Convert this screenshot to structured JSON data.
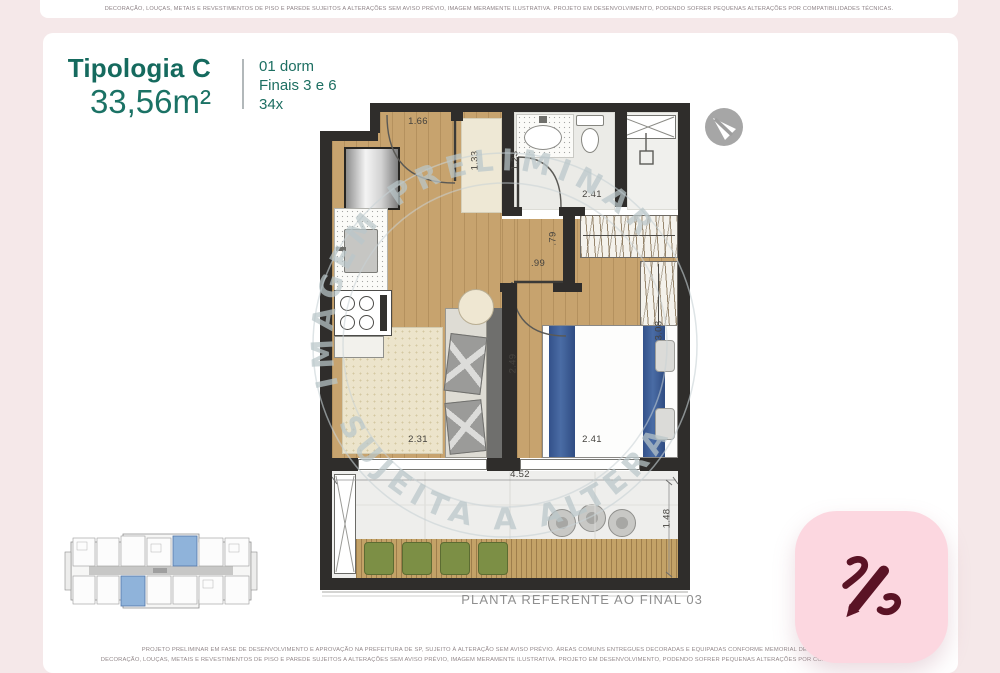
{
  "top_bar": {
    "disclaimer": "DECORAÇÃO, LOUÇAS, METAIS E REVESTIMENTOS DE PISO E PAREDE SUJEITOS A ALTERAÇÕES SEM AVISO PRÉVIO, IMAGEM MERAMENTE ILUSTRATIVA. PROJETO EM DESENVOLVIMENTO, PODENDO SOFRER PEQUENAS ALTERAÇÕES POR COMPATIBILIDADES TÉCNICAS."
  },
  "header": {
    "typology": "Tipologia C",
    "area": "33,56m²",
    "info_lines": [
      "01 dorm",
      "Finais 3 e 6",
      "34x"
    ],
    "accent_color": "#156a5e"
  },
  "plan": {
    "caption": "PLANTA REFERENTE AO FINAL 03",
    "watermark": {
      "upper": "IMAGEM PRELIMINAR",
      "lower": "SUJEITA A ALTERAÇÃO"
    },
    "dimensions": {
      "entry": "1.66",
      "closet": "1.33",
      "bath_width": "1.23",
      "bath_length": "2.41",
      "nook": ".79",
      "bedroom_door": ".99",
      "living_depth": "2.49",
      "living_width": "2.31",
      "bedroom_width": "2.41",
      "bedroom_depth": "3.08",
      "terrace_width": "4.52",
      "terrace_depth": "1.48"
    }
  },
  "footer": {
    "line1": "PROJETO PRELIMINAR EM FASE DE DESENVOLVIMENTO E APROVAÇÃO NA PREFEITURA DE SP, SUJEITO À ALTERAÇÃO SEM AVISO PRÉVIO. ÁREAS COMUNS ENTREGUES DECORADAS E EQUIPADAS CONFORME MEMORIAL DESCRITIVO. MÓVEIS,",
    "line2": "DECORAÇÃO, LOUÇAS, METAIS E REVESTIMENTOS DE PISO E PAREDE SUJEITOS A ALTERAÇÕES SEM AVISO PRÉVIO, IMAGEM MERAMENTE ILUSTRATIVA. PROJETO EM DESENVOLVIMENTO, PODENDO SOFRER PEQUENAS ALTERAÇÕES POR COMPATIBILIDADES TÉCNICAS."
  },
  "colors": {
    "accent": "#156a5e",
    "page_pink": "#f5e8e9",
    "icon_pink": "#fcd7e0",
    "pen_maroon": "#5a1325",
    "wall": "#2f2d2b",
    "wood_floor": "#c7a36e",
    "bed_blue": "#3c5f9d",
    "planter_green": "#7c8f45",
    "watermark": "#bac7ca"
  }
}
